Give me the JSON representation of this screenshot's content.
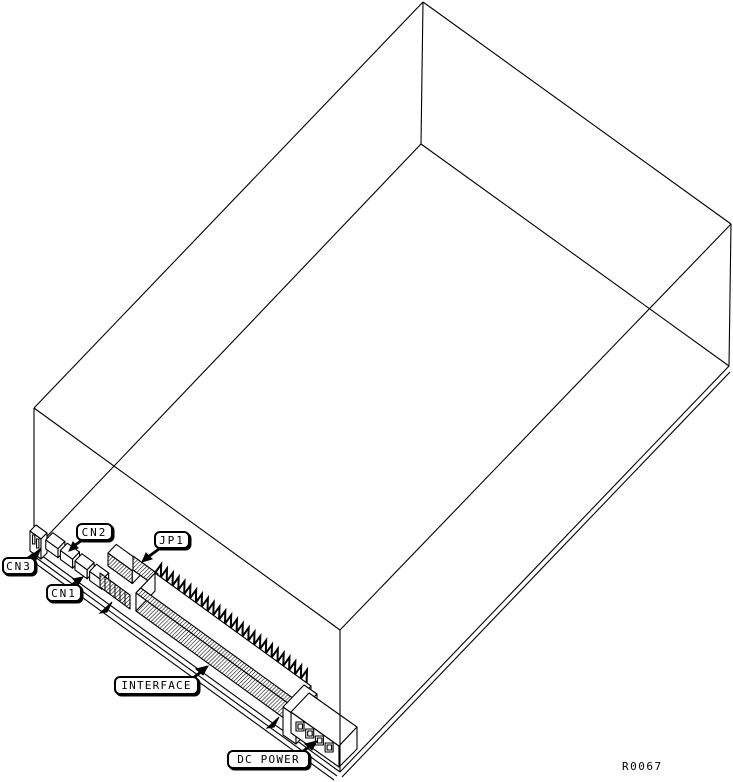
{
  "figure": {
    "callouts": [
      {
        "id": "cn3",
        "label": "CN3"
      },
      {
        "id": "cn2",
        "label": "CN2"
      },
      {
        "id": "cn1",
        "label": "CN1"
      },
      {
        "id": "jp1",
        "label": "JP1"
      },
      {
        "id": "interface",
        "label": "INTERFACE"
      },
      {
        "id": "dc_power",
        "label": "DC POWER"
      }
    ],
    "reference": "R0067",
    "colors": {
      "line": "#000000",
      "background": "#ffffff"
    }
  }
}
